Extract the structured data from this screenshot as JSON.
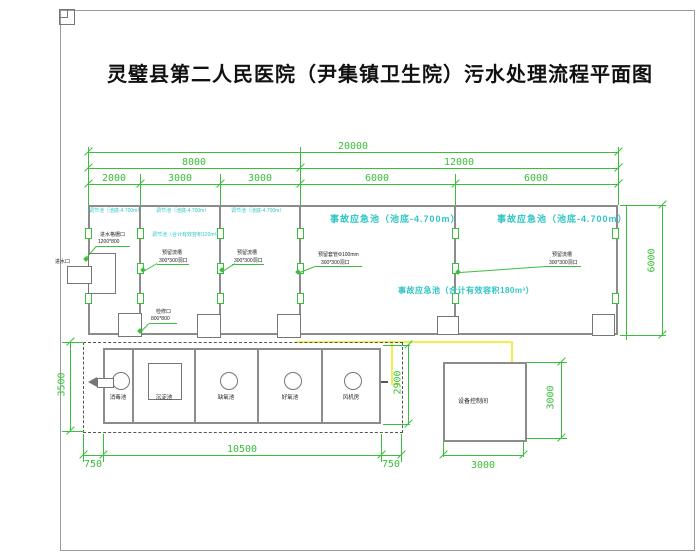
{
  "title": "灵璧县第二人民医院（尹集镇卫生院）污水处理流程平面图",
  "colors": {
    "dimension_green": "#3cbe3c",
    "label_cyan": "#2fc5c5",
    "cable_yellow": "#f2ee4e",
    "wall_gray": "#8c8c8c"
  },
  "dims": {
    "total_width": "20000",
    "left_half": "8000",
    "right_half": "12000",
    "row3": [
      "2000",
      "3000",
      "3000",
      "6000",
      "6000"
    ],
    "upper_right_height": "6000",
    "lower_left_height": "3500",
    "lower_mid_height": "2900",
    "bottom_left": "750",
    "bottom_center": "10500",
    "bottom_right": "750",
    "room_width": "3000",
    "room_height": "3000"
  },
  "upper_tanks": {
    "cell1": "调节池（池底-4.700m）",
    "cell2": "调节池（池底-4.700m）",
    "cell3": "调节池（池底-4.700m）",
    "combined": "调节池（合计有效容积120m³）",
    "accident1": "事故应急池（池底-4.700m）",
    "accident2": "事故应急池（池底-4.700m）",
    "accident_combined": "事故应急池（合计有效容积180m³）"
  },
  "annotations": {
    "inlet": "进水口",
    "grate_line1": "进水格栅口",
    "grate_line2": "1200*800",
    "chute_line1": "预留流槽",
    "chute_line2": "300*300洞口",
    "sleeve_line1": "预留套管Φ100mm",
    "sleeve_line2": "300*300洞口",
    "hatch_line1": "检修口",
    "hatch_line2": "800*800"
  },
  "bottom_tank": {
    "compartments": [
      "消毒池",
      "沉淀池",
      "缺氧池",
      "好氧池",
      "风机房"
    ]
  },
  "control_room": {
    "label": "设备控制间"
  }
}
